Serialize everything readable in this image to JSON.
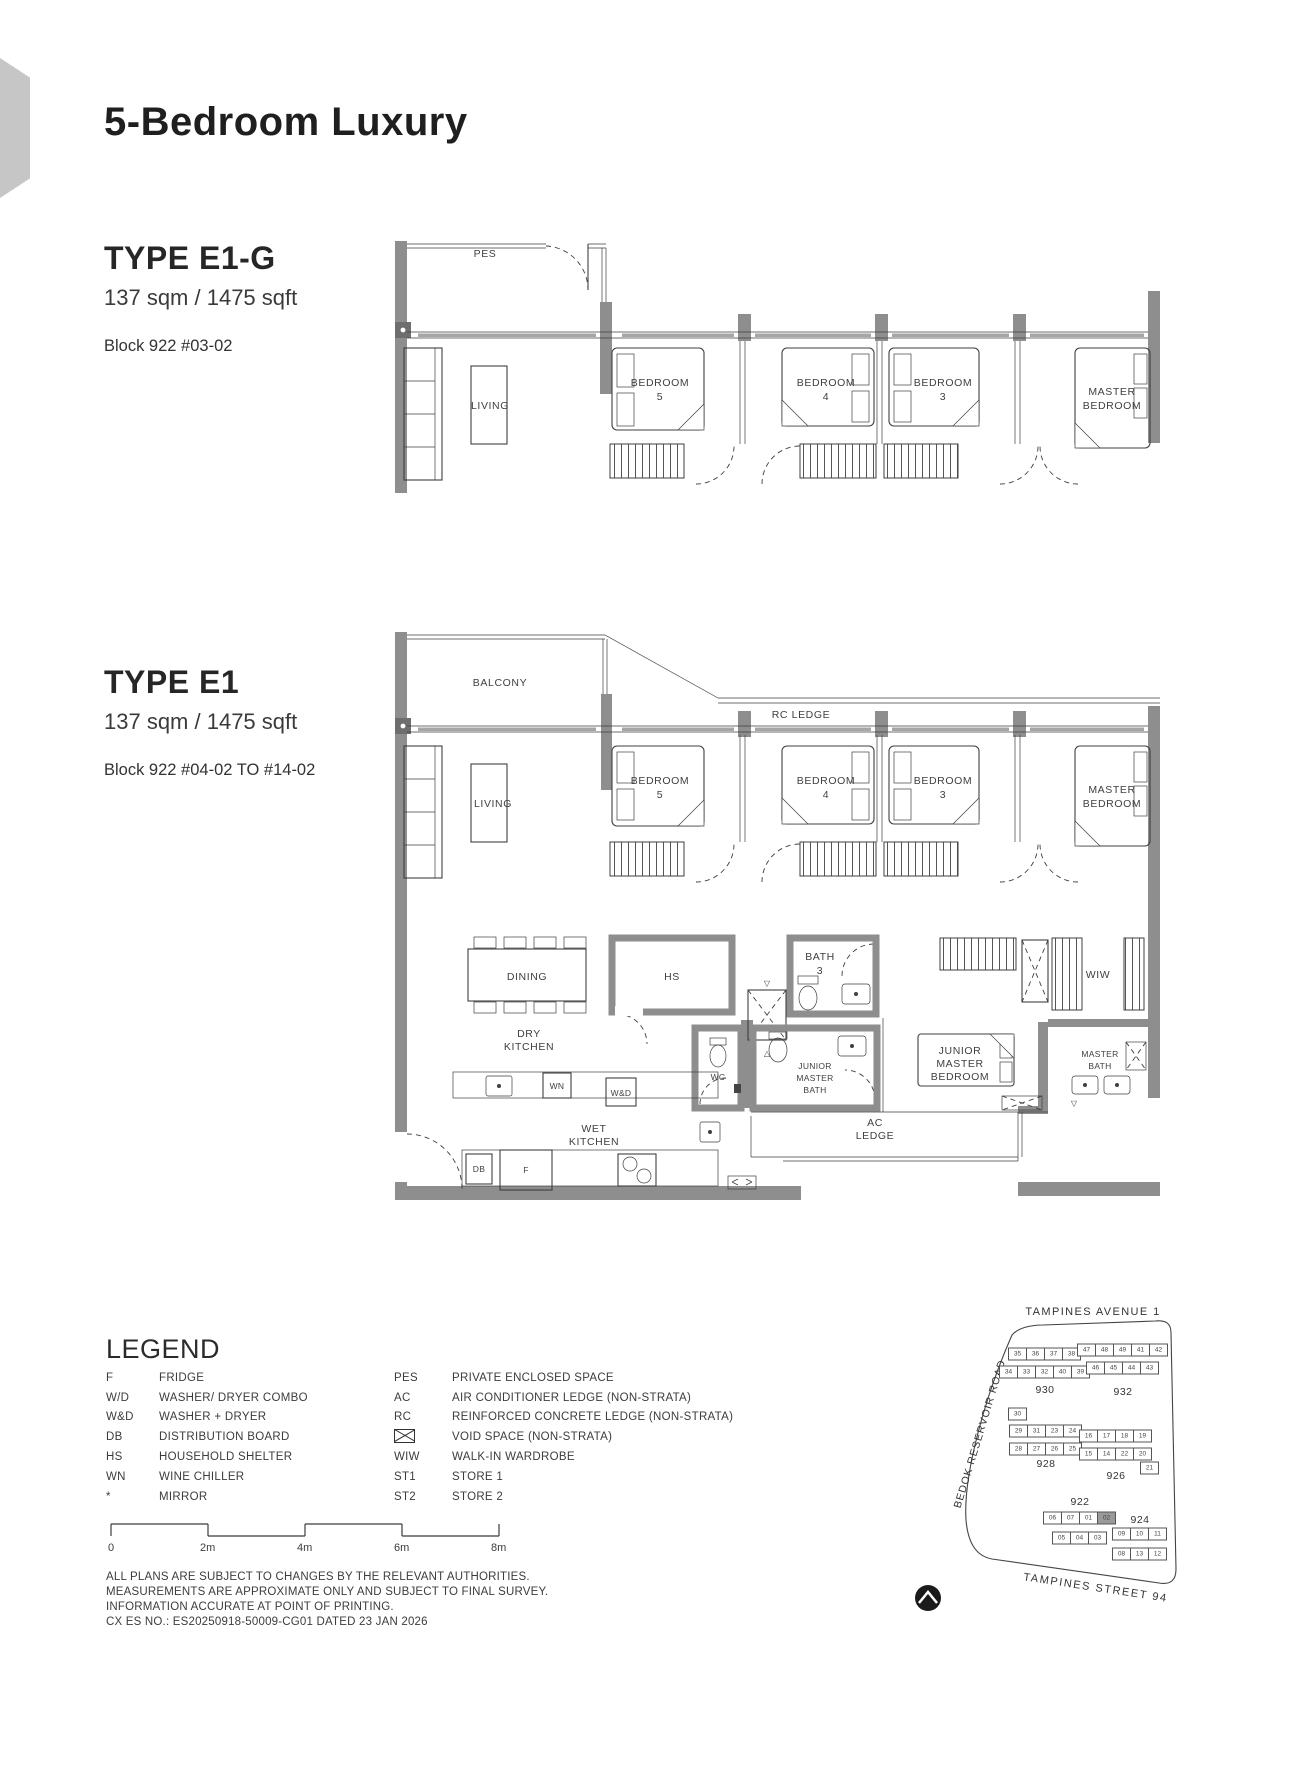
{
  "page": {
    "title": "5-Bedroom Luxury"
  },
  "unit_e1g": {
    "type_label": "TYPE E1-G",
    "area": "137 sqm / 1475 sqft",
    "block": "Block 922  #03-02",
    "rooms": {
      "pes": "PES",
      "living": "LIVING",
      "bedroom5_1": "BEDROOM",
      "bedroom5_2": "5",
      "bedroom4_1": "BEDROOM",
      "bedroom4_2": "4",
      "bedroom3_1": "BEDROOM",
      "bedroom3_2": "3",
      "master_1": "MASTER",
      "master_2": "BEDROOM"
    }
  },
  "unit_e1": {
    "type_label": "TYPE E1",
    "area": "137 sqm / 1475 sqft",
    "block": "Block 922  #04-02 TO #14-02",
    "rooms": {
      "balcony": "BALCONY",
      "rc_ledge": "RC LEDGE",
      "living": "LIVING",
      "bedroom5_1": "BEDROOM",
      "bedroom5_2": "5",
      "bedroom4_1": "BEDROOM",
      "bedroom4_2": "4",
      "bedroom3_1": "BEDROOM",
      "bedroom3_2": "3",
      "master_1": "MASTER",
      "master_2": "BEDROOM",
      "dining": "DINING",
      "hs": "HS",
      "bath3_1": "BATH",
      "bath3_2": "3",
      "wiw": "WIW",
      "dry_kitchen_1": "DRY",
      "dry_kitchen_2": "KITCHEN",
      "wc": "WC",
      "wn": "WN",
      "wd": "W&D",
      "jm_bath_1": "JUNIOR",
      "jm_bath_2": "MASTER",
      "jm_bath_3": "BATH",
      "jm_bed_1": "JUNIOR",
      "jm_bed_2": "MASTER",
      "jm_bed_3": "BEDROOM",
      "master_bath_1": "MASTER",
      "master_bath_2": "BATH",
      "wet_kitchen_1": "WET",
      "wet_kitchen_2": "KITCHEN",
      "fridge": "F",
      "db": "DB",
      "ac_ledge_1": "AC",
      "ac_ledge_2": "LEDGE"
    }
  },
  "legend": {
    "heading": "LEGEND",
    "left": [
      {
        "abbr": "F",
        "desc": "FRIDGE"
      },
      {
        "abbr": "W/D",
        "desc": "WASHER/ DRYER COMBO"
      },
      {
        "abbr": "W&D",
        "desc": "WASHER + DRYER"
      },
      {
        "abbr": "DB",
        "desc": "DISTRIBUTION BOARD"
      },
      {
        "abbr": "HS",
        "desc": "HOUSEHOLD SHELTER"
      },
      {
        "abbr": "WN",
        "desc": "WINE CHILLER"
      },
      {
        "abbr": "*",
        "desc": "MIRROR"
      }
    ],
    "right": [
      {
        "abbr": "PES",
        "desc": "PRIVATE ENCLOSED SPACE"
      },
      {
        "abbr": "AC",
        "desc": "AIR CONDITIONER LEDGE (NON-STRATA)"
      },
      {
        "abbr": "RC",
        "desc": "REINFORCED CONCRETE LEDGE (NON-STRATA)"
      },
      {
        "abbr": "",
        "desc": "VOID SPACE (NON-STRATA)",
        "icon": "void-space-icon"
      },
      {
        "abbr": "WIW",
        "desc": "WALK-IN WARDROBE"
      },
      {
        "abbr": "ST1",
        "desc": "STORE 1"
      },
      {
        "abbr": "ST2",
        "desc": "STORE 2"
      }
    ]
  },
  "scale_bar": {
    "labels": [
      "0",
      "2m",
      "4m",
      "6m",
      "8m"
    ]
  },
  "disclaimer": {
    "line1": "ALL PLANS ARE SUBJECT TO CHANGES BY THE RELEVANT AUTHORITIES.",
    "line2": "MEASUREMENTS ARE APPROXIMATE ONLY AND SUBJECT TO FINAL SURVEY.",
    "line3": "INFORMATION ACCURATE AT POINT OF PRINTING.",
    "line4": "CX ES NO.: ES20250918-50009-CG01 DATED 23 JAN 2026"
  },
  "site_map": {
    "road_top": "TAMPINES AVENUE 1",
    "road_left": "BEDOK RESERVOIR ROAD",
    "road_bottom": "TAMPINES STREET 94",
    "highlight_color": "#9a9a9a",
    "clusters": [
      {
        "label": "930",
        "cx": 205,
        "label_y": 112,
        "rows": [
          {
            "y": 76,
            "units": [
              "35",
              "36",
              "37",
              "38"
            ]
          },
          {
            "y": 94,
            "units": [
              "34",
              "33",
              "32",
              "40",
              "39"
            ]
          }
        ]
      },
      {
        "label": "932",
        "cx": 283,
        "label_y": 114,
        "rows": [
          {
            "y": 72,
            "units": [
              "47",
              "48",
              "49",
              "41",
              "42"
            ]
          },
          {
            "y": 90,
            "units": [
              "46",
              "45",
              "44",
              "43"
            ]
          }
        ]
      },
      {
        "label": "928",
        "cx": 206,
        "label_y": 186,
        "rows": [
          {
            "y": 136,
            "units": [
              "30"
            ],
            "dx": -28
          },
          {
            "y": 153,
            "units": [
              "29",
              "31",
              "23",
              "24"
            ]
          },
          {
            "y": 171,
            "units": [
              "28",
              "27",
              "26",
              "25"
            ]
          }
        ]
      },
      {
        "label": "926",
        "cx": 276,
        "label_y": 198,
        "rows": [
          {
            "y": 158,
            "units": [
              "16",
              "17",
              "18",
              "19"
            ]
          },
          {
            "y": 176,
            "units": [
              "15",
              "14",
              "22",
              "20"
            ]
          },
          {
            "y": 190,
            "units": [
              "21"
            ],
            "dx": 34
          }
        ]
      },
      {
        "label": "922",
        "cx": 240,
        "label_y": 224,
        "rows": [
          {
            "y": 240,
            "units": [
              "06",
              "07",
              "01",
              {
                "n": "02",
                "hl": true
              }
            ]
          },
          {
            "y": 260,
            "units": [
              "05",
              "04",
              "03"
            ]
          }
        ]
      },
      {
        "label": "924",
        "cx": 300,
        "label_y": 242,
        "rows": [
          {
            "y": 256,
            "units": [
              "09",
              "10",
              "11"
            ]
          },
          {
            "y": 276,
            "units": [
              "08",
              "13",
              "12"
            ]
          }
        ]
      }
    ]
  }
}
